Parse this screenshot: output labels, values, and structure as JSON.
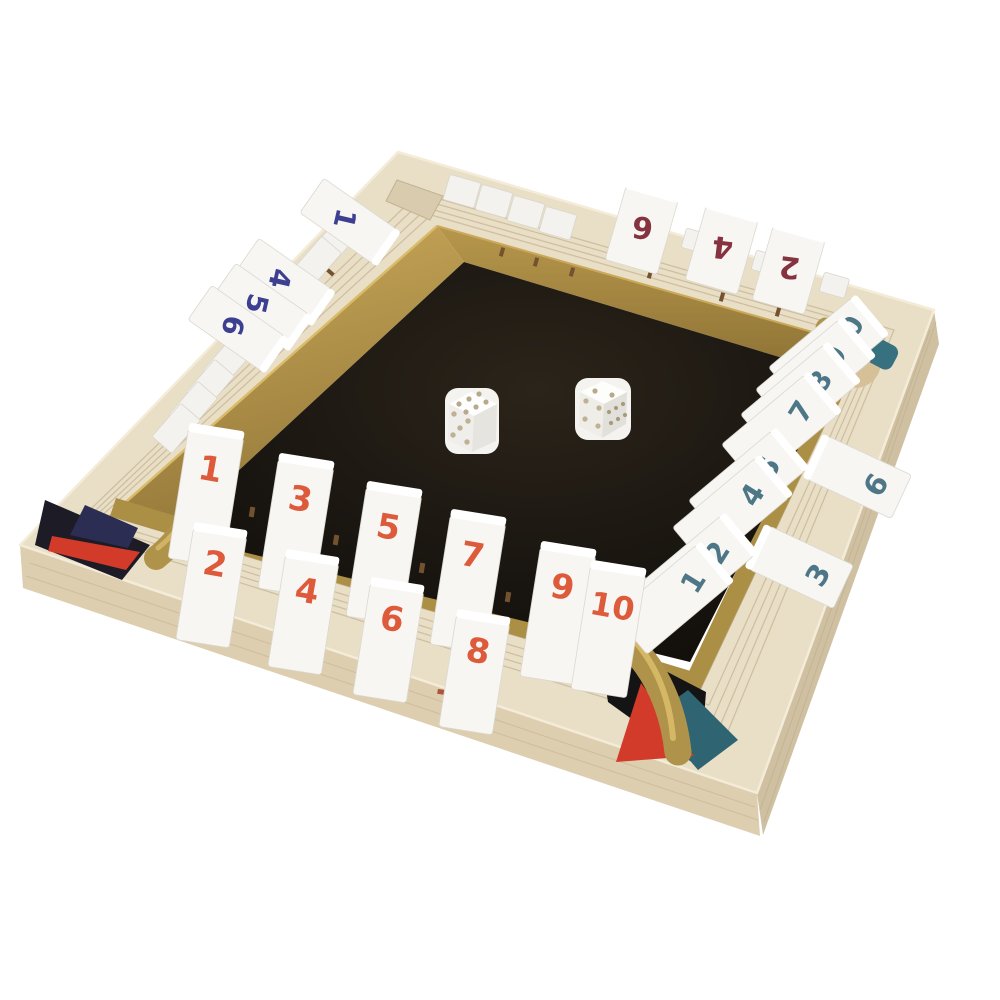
{
  "scene": {
    "subject": "Shut the Box wooden 4-player dice game board",
    "dice": [
      {
        "top": "6",
        "front": "5"
      },
      {
        "top": "2",
        "front": "4",
        "right": "6"
      }
    ],
    "palette": {
      "wood": "#e9dfc7",
      "wood_side": "#d6c7a8",
      "gold": "#b0934a",
      "felt": "#16120e",
      "tile": "#f7f6f2",
      "front_numbers": "#dd5a3a",
      "right_numbers": "#4d7687",
      "left_numbers": "#3d3f90",
      "far_numbers": "#84333f",
      "corner_red": "#d23b2a",
      "corner_teal": "#2f6472",
      "dice_pips": "#b3a284"
    }
  },
  "board": {
    "rows": {
      "front": {
        "number_color": "#dd5a3a",
        "tiles": [
          {
            "n": "1",
            "state": "open"
          },
          {
            "n": "2",
            "state": "open"
          },
          {
            "n": "3",
            "state": "open"
          },
          {
            "n": "4",
            "state": "open"
          },
          {
            "n": "5",
            "state": "open"
          },
          {
            "n": "6",
            "state": "open"
          },
          {
            "n": "7",
            "state": "open"
          },
          {
            "n": "8",
            "state": "open"
          },
          {
            "n": "9",
            "state": "open"
          },
          {
            "n": "10",
            "state": "open"
          }
        ]
      },
      "right": {
        "number_color": "#4d7687",
        "tiles": [
          {
            "n": "1",
            "state": "open"
          },
          {
            "n": "2",
            "state": "open"
          },
          {
            "n": "3",
            "state": "closed"
          },
          {
            "n": "4",
            "state": "open"
          },
          {
            "n": "5",
            "state": "open"
          },
          {
            "n": "6",
            "state": "closed"
          },
          {
            "n": "7",
            "state": "open"
          },
          {
            "n": "8",
            "state": "open"
          },
          {
            "n": "9",
            "state": "open"
          },
          {
            "n": "10",
            "state": "open"
          }
        ]
      },
      "left": {
        "number_color": "#3d3f90",
        "tiles": [
          {
            "n": "1",
            "state": "closed"
          },
          {
            "n": "2",
            "state": "open"
          },
          {
            "n": "3",
            "state": "open"
          },
          {
            "n": "4",
            "state": "closed"
          },
          {
            "n": "5",
            "state": "closed"
          },
          {
            "n": "6",
            "state": "closed"
          },
          {
            "n": "7",
            "state": "open"
          },
          {
            "n": "8",
            "state": "open"
          },
          {
            "n": "9",
            "state": "open"
          },
          {
            "n": "10",
            "state": "open"
          }
        ]
      },
      "far": {
        "number_color": "#84333f",
        "tiles": [
          {
            "n": "1",
            "state": "open"
          },
          {
            "n": "2",
            "state": "closed"
          },
          {
            "n": "3",
            "state": "open"
          },
          {
            "n": "4",
            "state": "closed"
          },
          {
            "n": "5",
            "state": "open"
          },
          {
            "n": "6",
            "state": "closed"
          },
          {
            "n": "7",
            "state": "open"
          },
          {
            "n": "8",
            "state": "open"
          },
          {
            "n": "9",
            "state": "open"
          },
          {
            "n": "10",
            "state": "open"
          }
        ]
      }
    }
  }
}
